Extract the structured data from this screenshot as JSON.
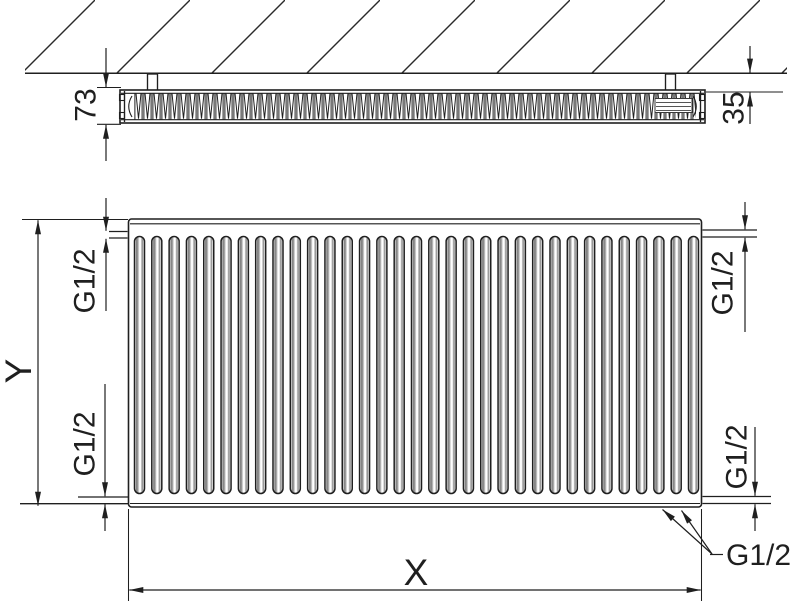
{
  "labels": {
    "top_view": {
      "depth": "73",
      "wall_distance": "35"
    },
    "front_view": {
      "height": "Y",
      "width": "X",
      "conn_top_left": "G1/2",
      "conn_top_right": "G1/2",
      "conn_bottom_left": "G1/2",
      "conn_bottom_right": "G1/2",
      "conn_bottom_valve": "G1/2"
    }
  },
  "colors": {
    "line": "#1f1f1f",
    "shade": "#8c8c8c",
    "background": "#ffffff"
  },
  "graphics": {
    "front_panel_channel_count": 33,
    "channel_first_x": 134.5,
    "channel_pitch": 17.3125,
    "channel_top_y": 236.5,
    "channel_width": 10,
    "channel_height": 257
  }
}
